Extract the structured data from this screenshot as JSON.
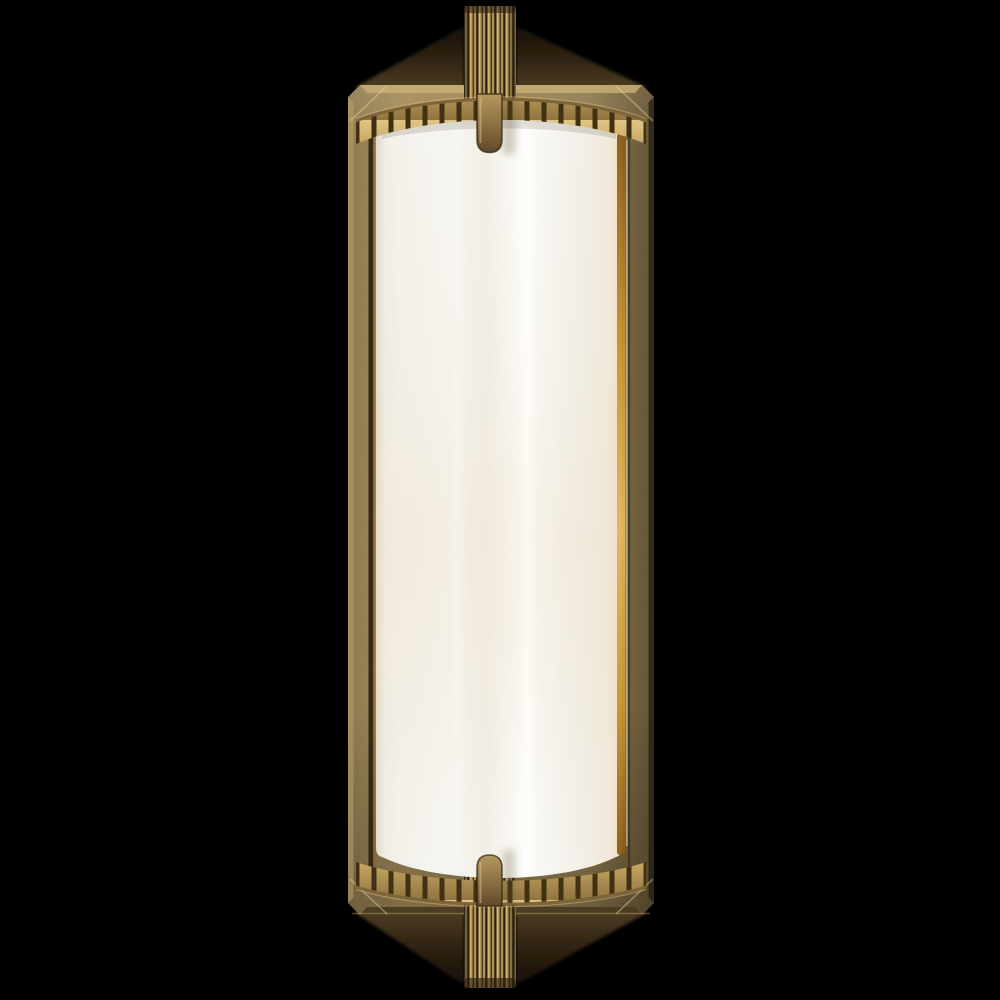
{
  "scene": {
    "type": "product-photograph",
    "subject": "Brass bath wall sconce with frosted white cylindrical glass shade, fluted top and bottom finial stems, gadrooned trim bands, rounded glass clips and a rectangular beveled backplate, photographed on a black background",
    "background": "#000000"
  },
  "fixture": {
    "parts": [
      {
        "name": "top-finial-stem",
        "description": "fluted brass stem above backplate"
      },
      {
        "name": "backplate",
        "description": "rectangular brass backplate with beveled chamfered corners"
      },
      {
        "name": "gadrooned-band-top",
        "description": "ribbed brass trim arc over top of glass"
      },
      {
        "name": "glass-shade",
        "description": "half-cylinder frosted white glass"
      },
      {
        "name": "glass-clip-top",
        "description": "rounded brass retaining clip, top center"
      },
      {
        "name": "glass-clip-bottom",
        "description": "rounded brass retaining clip, bottom center"
      },
      {
        "name": "gadrooned-band-bottom",
        "description": "ribbed brass trim arc under bottom of glass"
      },
      {
        "name": "bottom-finial-stem",
        "description": "fluted brass stem below backplate"
      },
      {
        "name": "wall-shadows",
        "description": "soft brown shadow wedges cast on wall behind stems"
      }
    ]
  },
  "colors": {
    "background": "#000000",
    "plateL": "#8d7950",
    "plateC": "#a58c5a",
    "plateM": "#95804d",
    "plateR": "#6f5e3b",
    "plateDeep": "#5d4e31",
    "bevelLight": "#c9b078",
    "plateBottomDark": "#473a20",
    "shadowDark": "#171008",
    "shadowMid": "#3b2c17",
    "shadowBrown": "#5f4b2c",
    "fluteLight": "#dcbe78",
    "fluteMid": "#b4955a",
    "fluteMid2": "#866b38",
    "fluteDark": "#43321a",
    "fluteDeep": "#241a0c",
    "ribFace1": "#e6cb8b",
    "ribFace2": "#c3a260",
    "ribFace3": "#8a6f3c",
    "ribGap": "#413112",
    "bandRail": "#7c653a",
    "bandRailLight": "#d9b978",
    "glassEdgeL": "#dfdacd",
    "glassWhite": "#f7f6f2",
    "glassSoft": "#f2efe8",
    "glassBright": "#fdfdfb",
    "glassCream": "#f1e9da",
    "glassWarm": "#eeddc2",
    "amberDark": "#8a5a16",
    "amberMid": "#c8922f",
    "amberLight": "#e3b55c",
    "clipLight": "#b4985e",
    "clipMid": "#8d7244",
    "clipDark": "#61492a",
    "clipOutline": "#2a1e0d"
  }
}
